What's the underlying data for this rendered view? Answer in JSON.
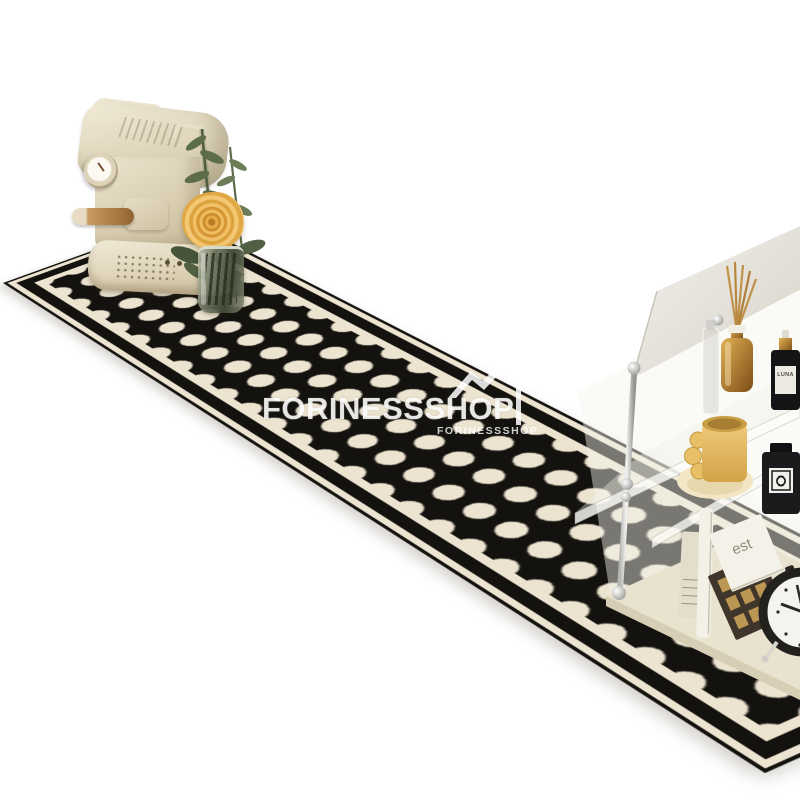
{
  "scene": {
    "type": "product-photo",
    "background_color": "#ffffff",
    "subject": "black and cream circle-pattern kitchen runner rug styled with a coffee machine, rose in glass vase, and acrylic shelf"
  },
  "watermark": {
    "brand_main": "FORINESSSHOP",
    "brand_small": "FORINESSSHOP",
    "logo": "double-peak-swoosh-logo",
    "color": "#ffffff"
  },
  "rug": {
    "name": "polka-dot-runner-rug",
    "dot_color": "#ece4d0",
    "ground_color": "#14120e",
    "field_color": "#ece4d0",
    "border": "thin black outline, cream gap, thick black band",
    "pattern": "grid of cream circles on black with four-point star gaps"
  },
  "coffee_machine": {
    "name": "cream-espresso-machine",
    "body_color": "#e7dfc8",
    "handle": "wooden portafilter handle",
    "gauge": "round pressure gauge"
  },
  "decor": {
    "flower": "yellow rose",
    "flower_color": "#e8ab45",
    "vase": "glass vase with green stems",
    "plant": "green leafy stems"
  },
  "shelf": {
    "name": "acrylic-shelf-unit",
    "luna_text": "LUNA",
    "book_text": "est",
    "items": [
      "clear glass bottle",
      "gold reed diffuser",
      "LUNA dropper bottle",
      "yellow mug on donut coaster",
      "striped book",
      "tall white book",
      "est cover book",
      "bronze gold-pattern box",
      "black perfume bottle",
      "black alarm clock"
    ]
  }
}
